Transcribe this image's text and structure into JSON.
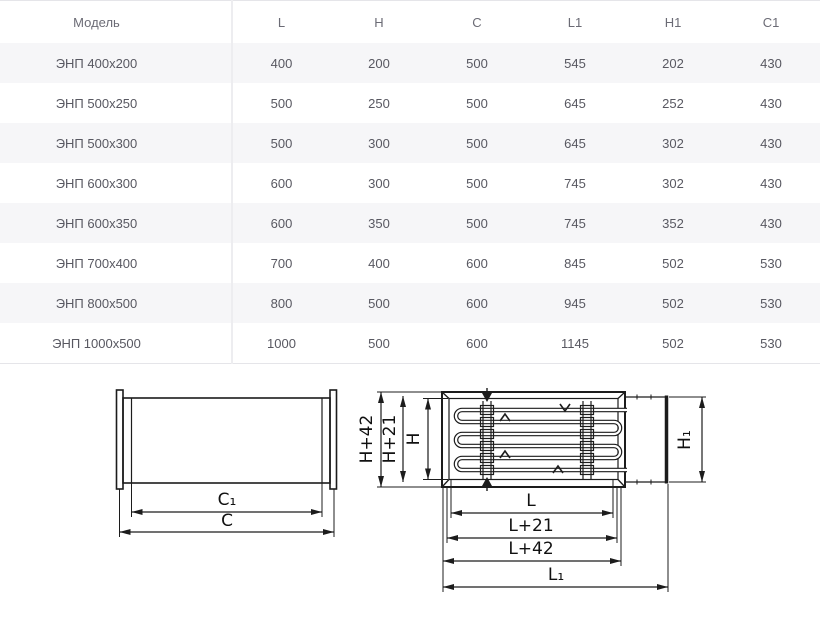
{
  "table": {
    "columns": [
      "Модель",
      "L",
      "H",
      "C",
      "L1",
      "H1",
      "C1"
    ],
    "rows": [
      [
        "ЭНП 400x200",
        "400",
        "200",
        "500",
        "545",
        "202",
        "430"
      ],
      [
        "ЭНП 500x250",
        "500",
        "250",
        "500",
        "645",
        "252",
        "430"
      ],
      [
        "ЭНП 500x300",
        "500",
        "300",
        "500",
        "645",
        "302",
        "430"
      ],
      [
        "ЭНП 600x300",
        "600",
        "300",
        "500",
        "745",
        "302",
        "430"
      ],
      [
        "ЭНП 600x350",
        "600",
        "350",
        "500",
        "745",
        "352",
        "430"
      ],
      [
        "ЭНП 700x400",
        "700",
        "400",
        "600",
        "845",
        "502",
        "530"
      ],
      [
        "ЭНП 800x500",
        "800",
        "500",
        "600",
        "945",
        "502",
        "530"
      ],
      [
        "ЭНП 1000x500",
        "1000",
        "500",
        "600",
        "1145",
        "502",
        "530"
      ]
    ]
  },
  "drawings": {
    "left": {
      "dim_c1": "C₁",
      "dim_c": "C"
    },
    "right": {
      "dim_h42": "H+42",
      "dim_h21": "H+21",
      "dim_h": "H",
      "dim_h1": "H₁",
      "dim_l": "L",
      "dim_l21": "L+21",
      "dim_l42": "L+42",
      "dim_l1": "L₁"
    }
  },
  "colors": {
    "stripe": "#f6f6f8",
    "border": "#e5e5e9",
    "line": "#1c1c1c"
  }
}
